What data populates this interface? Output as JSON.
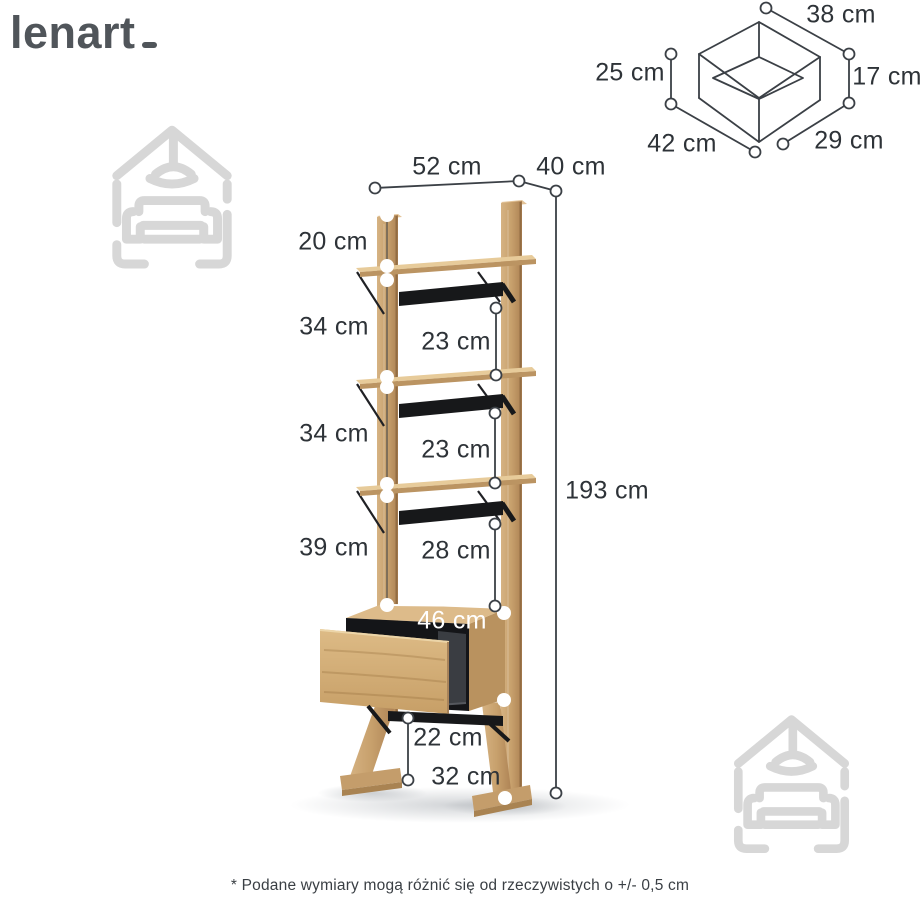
{
  "brand": {
    "name": "lenart"
  },
  "footnote": "* Podane wymiary mogą różnić się od rzeczywistych o +/- 0,5 cm",
  "colors": {
    "wood": "#c7a06c",
    "wood_light": "#e7cb9a",
    "metal_strap": "#17181a",
    "dimension_line": "#3b4046",
    "label_text": "#2e3338",
    "watermark": "#d7d7d7",
    "logo": "#50555a",
    "white_marker": "#ffffff"
  },
  "shelf_diagram": {
    "description": "tall oak ladder shelf with drawer, dimension callouts",
    "dimensions": [
      {
        "id": "width-top",
        "label": "52 cm"
      },
      {
        "id": "depth-top",
        "label": "40 cm"
      },
      {
        "id": "top-overhang",
        "label": "20 cm"
      },
      {
        "id": "gap-upper",
        "label": "34 cm"
      },
      {
        "id": "clearance-upper",
        "label": "23 cm"
      },
      {
        "id": "gap-middle",
        "label": "34 cm"
      },
      {
        "id": "clearance-middle",
        "label": "23 cm"
      },
      {
        "id": "total-height",
        "label": "193 cm"
      },
      {
        "id": "gap-lower",
        "label": "39 cm"
      },
      {
        "id": "clearance-lower",
        "label": "28 cm"
      },
      {
        "id": "drawer-width",
        "label": "46 cm"
      },
      {
        "id": "base-clearance",
        "label": "22 cm"
      },
      {
        "id": "foot-depth",
        "label": "32 cm"
      }
    ]
  },
  "box_diagram": {
    "description": "open drawer box line drawing, dimension callouts",
    "dimensions": [
      {
        "id": "top-width",
        "label": "38 cm"
      },
      {
        "id": "right-height",
        "label": "17 cm"
      },
      {
        "id": "side-depth",
        "label": "29 cm"
      },
      {
        "id": "bottom-width",
        "label": "42 cm"
      },
      {
        "id": "left-height",
        "label": "25 cm"
      }
    ]
  }
}
